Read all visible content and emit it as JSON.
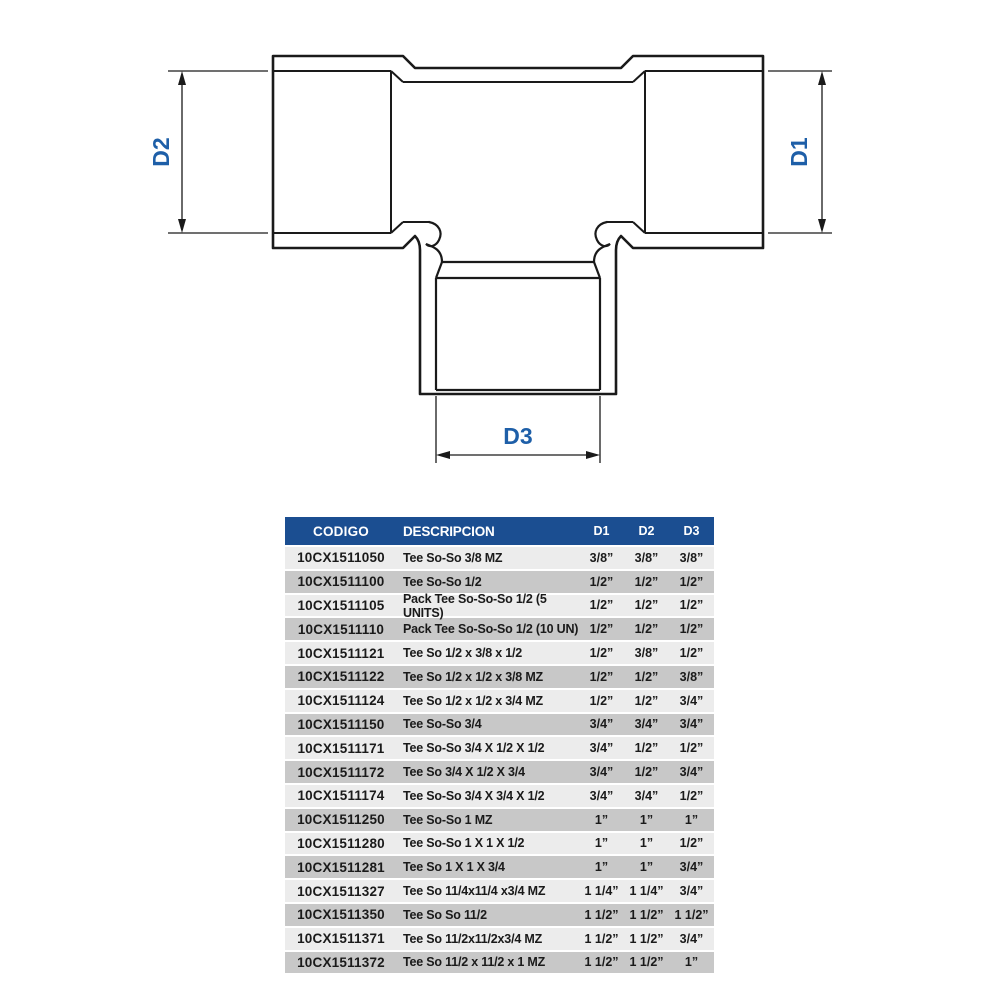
{
  "diagram": {
    "d1_label": "D1",
    "d2_label": "D2",
    "d3_label": "D3",
    "label_color": "#1e5fa8",
    "line_color": "#1a1a1a"
  },
  "table": {
    "header_bg": "#1b4e91",
    "row_light": "#ececec",
    "row_dark": "#c8c8c8",
    "headers": {
      "codigo": "CODIGO",
      "descripcion": "DESCRIPCION",
      "d1": "D1",
      "d2": "D2",
      "d3": "D3"
    },
    "rows": [
      {
        "code": "10CX1511050",
        "desc": "Tee So-So 3/8 MZ",
        "d1": "3/8”",
        "d2": "3/8”",
        "d3": "3/8”"
      },
      {
        "code": "10CX1511100",
        "desc": "Tee So-So 1/2",
        "d1": "1/2”",
        "d2": "1/2”",
        "d3": "1/2”"
      },
      {
        "code": "10CX1511105",
        "desc": "Pack Tee So-So-So 1/2 (5 UNITS)",
        "d1": "1/2”",
        "d2": "1/2”",
        "d3": "1/2”"
      },
      {
        "code": "10CX1511110",
        "desc": "Pack Tee So-So-So 1/2 (10 UN)",
        "d1": "1/2”",
        "d2": "1/2”",
        "d3": "1/2”"
      },
      {
        "code": "10CX1511121",
        "desc": "Tee So 1/2 x 3/8 x 1/2",
        "d1": "1/2”",
        "d2": "3/8”",
        "d3": "1/2”"
      },
      {
        "code": "10CX1511122",
        "desc": "Tee So 1/2 x 1/2 x 3/8 MZ",
        "d1": "1/2”",
        "d2": "1/2”",
        "d3": "3/8”"
      },
      {
        "code": "10CX1511124",
        "desc": "Tee So 1/2 x 1/2 x 3/4 MZ",
        "d1": "1/2”",
        "d2": "1/2”",
        "d3": "3/4”"
      },
      {
        "code": "10CX1511150",
        "desc": "Tee So-So 3/4",
        "d1": "3/4”",
        "d2": "3/4”",
        "d3": "3/4”"
      },
      {
        "code": "10CX1511171",
        "desc": "Tee So-So 3/4 X 1/2 X 1/2",
        "d1": "3/4”",
        "d2": "1/2”",
        "d3": "1/2”"
      },
      {
        "code": "10CX1511172",
        "desc": "Tee So 3/4 X 1/2 X 3/4",
        "d1": "3/4”",
        "d2": "1/2”",
        "d3": "3/4”"
      },
      {
        "code": "10CX1511174",
        "desc": "Tee So-So 3/4 X 3/4 X 1/2",
        "d1": "3/4”",
        "d2": "3/4”",
        "d3": "1/2”"
      },
      {
        "code": "10CX1511250",
        "desc": "Tee So-So 1 MZ",
        "d1": "1”",
        "d2": "1”",
        "d3": "1”"
      },
      {
        "code": "10CX1511280",
        "desc": "Tee So-So 1 X 1 X 1/2",
        "d1": "1”",
        "d2": "1”",
        "d3": "1/2”"
      },
      {
        "code": "10CX1511281",
        "desc": "Tee So 1 X 1 X 3/4",
        "d1": "1”",
        "d2": "1”",
        "d3": "3/4”"
      },
      {
        "code": "10CX1511327",
        "desc": "Tee So 11/4x11/4 x3/4 MZ",
        "d1": "1 1/4”",
        "d2": "1 1/4”",
        "d3": "3/4”"
      },
      {
        "code": "10CX1511350",
        "desc": "Tee So So 11/2",
        "d1": "1 1/2”",
        "d2": "1 1/2”",
        "d3": "1 1/2”"
      },
      {
        "code": "10CX1511371",
        "desc": "Tee So 11/2x11/2x3/4 MZ",
        "d1": "1 1/2”",
        "d2": "1 1/2”",
        "d3": "3/4”"
      },
      {
        "code": "10CX1511372",
        "desc": "Tee So 11/2 x 11/2 x 1 MZ",
        "d1": "1 1/2”",
        "d2": "1 1/2”",
        "d3": "1”"
      }
    ]
  }
}
